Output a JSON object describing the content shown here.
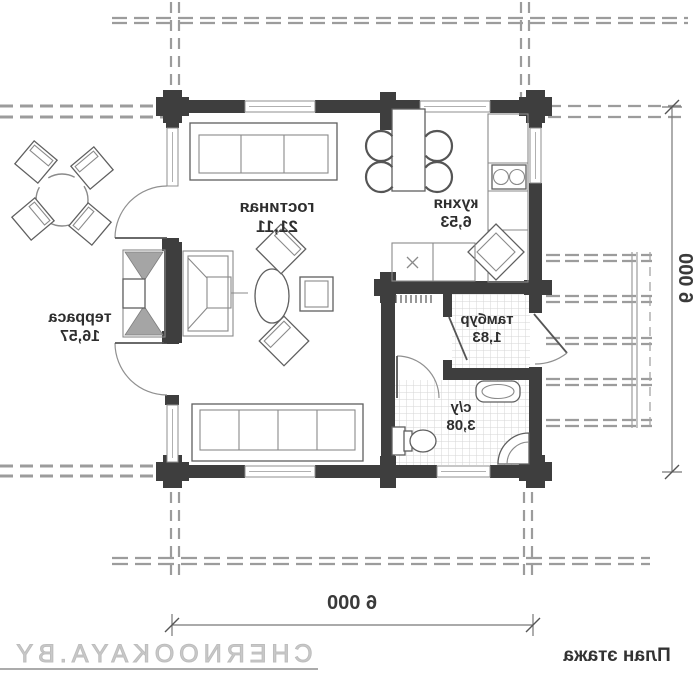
{
  "rooms": {
    "living": {
      "name": "гостиная",
      "area": "21,11"
    },
    "kitchen": {
      "name": "кухня",
      "area": "6,53"
    },
    "terrace": {
      "name": "терраса",
      "area": "16,57"
    },
    "tambour": {
      "name": "тамбур",
      "area": "1,83"
    },
    "wc": {
      "name": "с/у",
      "area": "3,08"
    }
  },
  "dimensions": {
    "bottom": "6 000",
    "right": "6 000"
  },
  "footer": {
    "watermark": "CHERNOOKAYA.BY",
    "plan_label": "План этажа"
  },
  "style": {
    "wall_color": "#3e3e3e",
    "line_color": "#9c9c9c",
    "text_color": "#2e2e2e",
    "watermark_color": "#c9c9c9"
  },
  "furniture": [
    "sofa-3-seat",
    "sofa-4-seat",
    "coffee-table",
    "armchair",
    "dining-table-with-chairs",
    "kitchen-counter",
    "stove",
    "corner-sink",
    "washer-unit",
    "toilet",
    "wash-basin",
    "corner-shower",
    "fireplace",
    "terrace-table-with-chairs",
    "porch-deck",
    "radiator"
  ]
}
